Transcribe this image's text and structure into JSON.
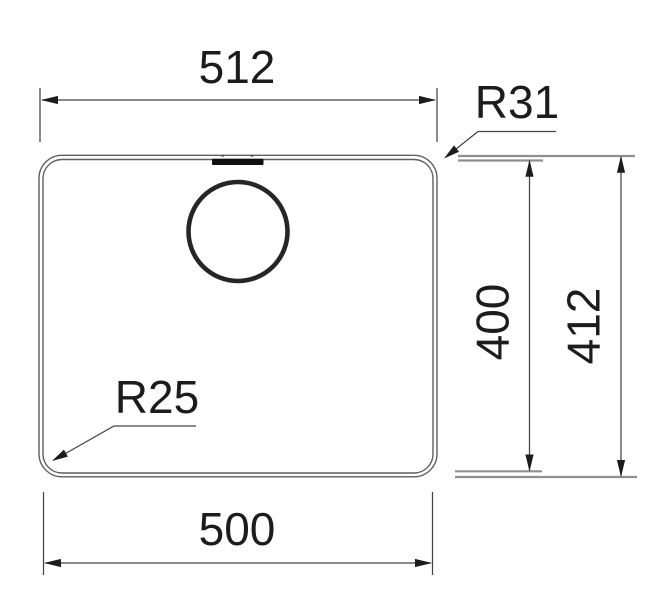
{
  "diagram": {
    "kind": "sink-cutout-technical-drawing",
    "labels": {
      "dim_top_width": "512",
      "dim_bottom_width": "500",
      "dim_inner_height": "400",
      "dim_outer_height": "412",
      "radius_top_right": "R31",
      "radius_bottom_left": "R25"
    },
    "colors": {
      "background": "#ffffff",
      "outline": "#5f5f5f",
      "dimension_line": "#444444",
      "extension_gray": "#8f8f8f",
      "arrow": "#1c1c1c",
      "text": "#1c1c1c",
      "drain_circle": "#262626",
      "overflow_slot": "#101010"
    }
  }
}
